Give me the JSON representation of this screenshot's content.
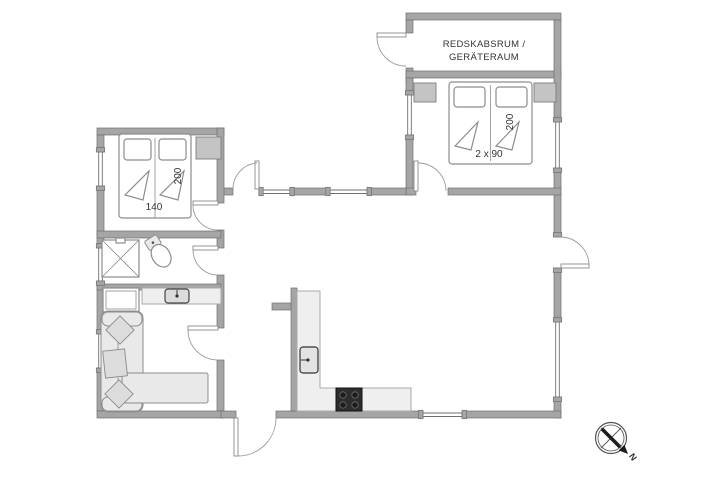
{
  "title": "summer-house-floor-plan",
  "labels": {
    "tool_room_line1": "REDSKABSRUM /",
    "tool_room_line2": "GERÄTERAUM",
    "bed_right_width": "2 x 90",
    "bed_right_length": "200",
    "bed_left_width": "140",
    "bed_left_length": "200",
    "compass_north": "N"
  },
  "colors": {
    "wall-fill": "#a5a5a5",
    "wall-outline": "#6f6f6f",
    "line": "#8c8c8c",
    "soft": "#e9e9e9",
    "wardrobe": "#c4c4c4",
    "counter": "#efefef",
    "stove": "#2d2d2d",
    "text": "#333333",
    "bg": "#ffffff"
  }
}
